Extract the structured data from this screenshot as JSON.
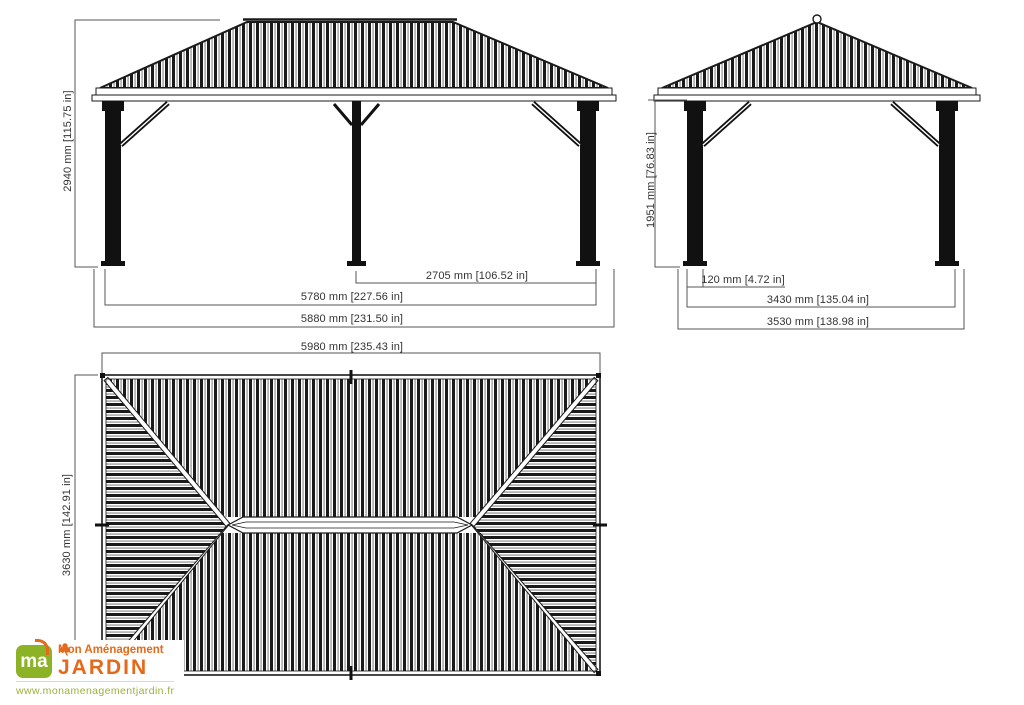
{
  "colors": {
    "line": "#1a1a1a",
    "dimension": "#3c3c3c",
    "brand_orange": "#e5691a",
    "brand_green": "#8cb226",
    "url_green": "#9fae3e"
  },
  "views": {
    "front": {
      "height_label": "2940 mm [115.75 in]",
      "bay_label": "2705 mm [106.52 in]",
      "span_label": "5780 mm [227.56 in]",
      "overall_label": "5880 mm [231.50 in]"
    },
    "side": {
      "height_label": "1951 mm [76.83 in]",
      "post_label": "120 mm [4.72 in]",
      "span_label": "3430 mm [135.04 in]",
      "overall_label": "3530 mm [138.98 in]"
    },
    "plan": {
      "width_label": "5980 mm [235.43 in]",
      "depth_label": "3630 mm [142.91 in]"
    }
  },
  "logo": {
    "monogram": "ma",
    "line1": "Mon Aménagement",
    "line2": "JARDIN",
    "website": "www.monamenagementjardin.fr"
  }
}
